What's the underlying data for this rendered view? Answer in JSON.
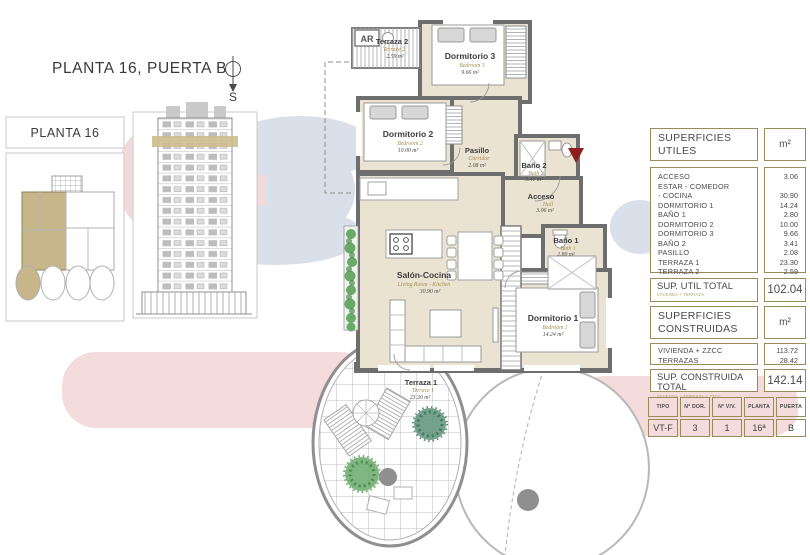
{
  "header": {
    "title": "PLANTA 16, PUERTA B",
    "compass_label": "S"
  },
  "sidebar": {
    "floor_label": "PLANTA 16"
  },
  "plan": {
    "ar_label": "AR",
    "rooms": [
      {
        "name": "Terraza 2",
        "sub": "Terrace 2",
        "area": "2.59 m²"
      },
      {
        "name": "Dormitorio 3",
        "sub": "Bedroom 3",
        "area": "9.66 m²"
      },
      {
        "name": "Dormitorio 2",
        "sub": "Bedroom 2",
        "area": "10.00 m²"
      },
      {
        "name": "Pasillo",
        "sub": "Corridor",
        "area": "2.08 m²"
      },
      {
        "name": "Baño 2",
        "sub": "Bath 2",
        "area": "3.41 m²"
      },
      {
        "name": "Acceso",
        "sub": "Hall",
        "area": "3.06 m²"
      },
      {
        "name": "Baño 1",
        "sub": "Bath 1",
        "area": "2.80 m²"
      },
      {
        "name": "Salón-Cocina",
        "sub": "Living Room - Kitchen",
        "area": "30.90 m²"
      },
      {
        "name": "Dormitorio 1",
        "sub": "Bedroom 1",
        "area": "14.24 m²"
      },
      {
        "name": "Terraza 1",
        "sub": "Terrace 1",
        "area": "23.30 m²"
      }
    ]
  },
  "tables": {
    "utiles": {
      "title": "SUPERFICIES UTILES",
      "unit": "m²",
      "rows": [
        {
          "label": "ACCESO",
          "value": "3.06"
        },
        {
          "label": "ESTAR - COMEDOR",
          "value": ""
        },
        {
          "label": "- COCINA",
          "value": "30.90"
        },
        {
          "label": "DORMITORIO 1",
          "value": "14.24"
        },
        {
          "label": "BAÑO 1",
          "value": "2.80"
        },
        {
          "label": "DORMITORIO 2",
          "value": "10.00"
        },
        {
          "label": "DORMITORIO 3",
          "value": "9.66"
        },
        {
          "label": "BAÑO 2",
          "value": "3.41"
        },
        {
          "label": "PASILLO",
          "value": "2.08"
        },
        {
          "label": "TERRAZA 1",
          "value": "23.30"
        },
        {
          "label": "TERRAZA 2",
          "value": "2.59"
        }
      ],
      "total_label": "SUP. UTIL TOTAL",
      "total_sub": "VIVIENDA + TERRAZA",
      "total_value": "102.04"
    },
    "construidas": {
      "title": "SUPERFICIES CONSTRUIDAS",
      "unit": "m²",
      "rows": [
        {
          "label": "VIVIENDA + ZZCC",
          "value": "113.72"
        },
        {
          "label": "TERRAZAS",
          "value": "28.42"
        }
      ],
      "total_label": "SUP. CONSTRUIDA TOTAL",
      "total_sub": "VIVIENDA + TERRAZA + ZZCC",
      "total_value": "142.14"
    },
    "unit_info": {
      "headers": [
        "TIPO",
        "Nº DOR.",
        "Nº VIV.",
        "PLANTA",
        "PUERTA"
      ],
      "values": [
        "VT-F",
        "3",
        "1",
        "16ª",
        "B"
      ]
    }
  },
  "colors": {
    "wall_gray": "#6e6e6e",
    "floor_cream": "#ebe3d2",
    "table_border": "#9b8b5b",
    "highlight_tan": "#c7b68a",
    "entry_red": "#8e1d1d",
    "blob_pink": "#f5dcdc",
    "blob_blue": "#d9e0ea"
  }
}
